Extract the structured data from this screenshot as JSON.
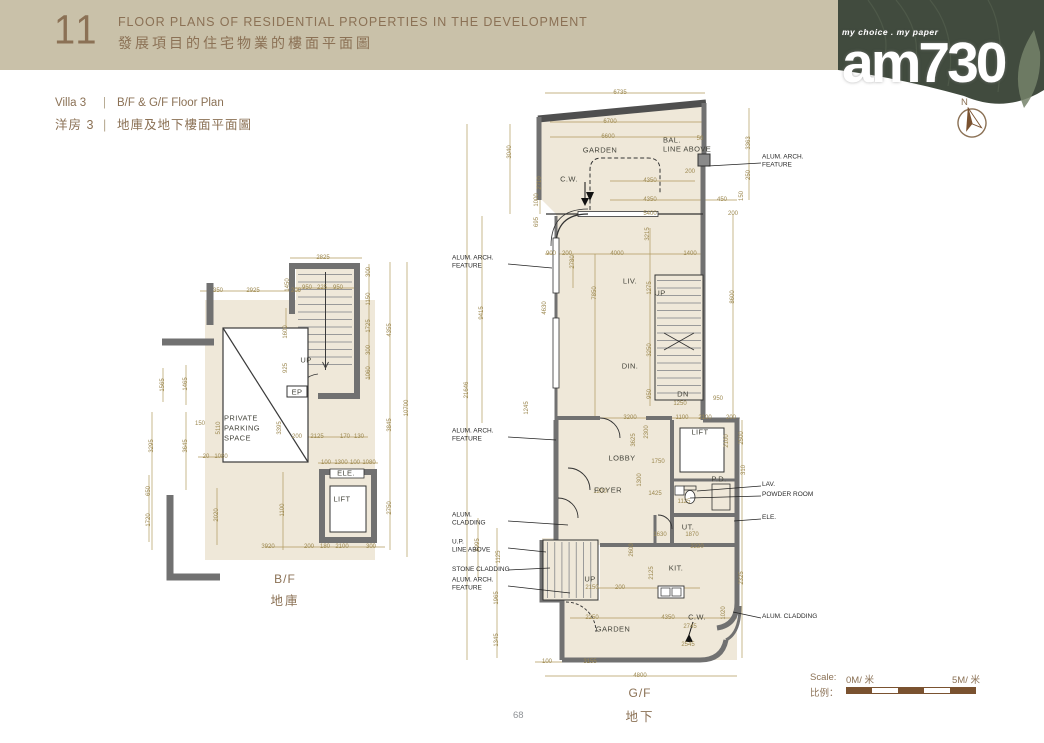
{
  "header": {
    "number": "11",
    "title_en": "FLOOR PLANS OF RESIDENTIAL PROPERTIES IN THE DEVELOPMENT",
    "title_zh": "發展項目的住宅物業的樓面平面圖"
  },
  "logo": {
    "tagline": "my choice . my paper",
    "name": "am730"
  },
  "compass": {
    "label": "N"
  },
  "subtitle": {
    "villa_en": "Villa 3",
    "sep": "|",
    "plan_en": "B/F & G/F Floor Plan",
    "villa_zh": "洋房 3",
    "plan_zh": "地庫及地下樓面平面圖"
  },
  "scale": {
    "label_en": "Scale:",
    "start": "0M/ 米",
    "end": "5M/ 米",
    "label_zh": "比例："
  },
  "page": {
    "number": "68"
  },
  "colors": {
    "banner": "#c9c1a9",
    "brown_text": "#8b7155",
    "green_corner": "#414b3e",
    "dim_gold": "#9c8850",
    "floor_cream": "#efe8d9",
    "wall_gray": "#717171",
    "scale_brown": "#7a5230"
  },
  "bf": {
    "caption_en": "B/F",
    "caption_zh": "地庫",
    "rooms": [
      {
        "x": 84,
        "y": 168,
        "t": "PRIVATE",
        "l": true
      },
      {
        "x": 84,
        "y": 178,
        "t": "PARKING",
        "l": true
      },
      {
        "x": 84,
        "y": 188,
        "t": "SPACE",
        "l": true
      },
      {
        "x": 166,
        "y": 110,
        "t": "UP"
      },
      {
        "x": 157,
        "y": 142,
        "t": "EP"
      },
      {
        "x": 206,
        "y": 223,
        "t": "ELE."
      },
      {
        "x": 202,
        "y": 249,
        "t": "LIFT"
      }
    ],
    "dims": [
      {
        "x": 183,
        "y": 8,
        "t": "2825"
      },
      {
        "x": 167,
        "y": 38,
        "t": "950"
      },
      {
        "x": 182,
        "y": 38,
        "t": "225"
      },
      {
        "x": 198,
        "y": 38,
        "t": "950"
      },
      {
        "x": 78,
        "y": 41,
        "t": "350"
      },
      {
        "x": 113,
        "y": 41,
        "t": "2925"
      },
      {
        "x": 156,
        "y": 41,
        "t": "200"
      },
      {
        "x": 148,
        "y": 35,
        "t": "1450",
        "v": true
      },
      {
        "x": 229,
        "y": 22,
        "t": "300",
        "v": true
      },
      {
        "x": 229,
        "y": 49,
        "t": "1150",
        "v": true
      },
      {
        "x": 229,
        "y": 76,
        "t": "1725",
        "v": true
      },
      {
        "x": 229,
        "y": 100,
        "t": "300",
        "v": true
      },
      {
        "x": 229,
        "y": 123,
        "t": "1060",
        "v": true
      },
      {
        "x": 250,
        "y": 80,
        "t": "4355",
        "v": true
      },
      {
        "x": 250,
        "y": 175,
        "t": "3845",
        "v": true
      },
      {
        "x": 250,
        "y": 258,
        "t": "2750",
        "v": true
      },
      {
        "x": 267,
        "y": 158,
        "t": "10700",
        "v": true
      },
      {
        "x": 23,
        "y": 135,
        "t": "1565",
        "v": true
      },
      {
        "x": 46,
        "y": 134,
        "t": "1465",
        "v": true
      },
      {
        "x": 60,
        "y": 174,
        "t": "150"
      },
      {
        "x": 12,
        "y": 196,
        "t": "3295",
        "v": true
      },
      {
        "x": 46,
        "y": 196,
        "t": "3645",
        "v": true
      },
      {
        "x": 79,
        "y": 178,
        "t": "5110",
        "v": true
      },
      {
        "x": 140,
        "y": 178,
        "t": "3395",
        "v": true
      },
      {
        "x": 146,
        "y": 82,
        "t": "1600",
        "v": true
      },
      {
        "x": 146,
        "y": 118,
        "t": "925",
        "v": true
      },
      {
        "x": 157,
        "y": 187,
        "t": "200"
      },
      {
        "x": 177,
        "y": 187,
        "t": "2125"
      },
      {
        "x": 205,
        "y": 187,
        "t": "170"
      },
      {
        "x": 219,
        "y": 187,
        "t": "130"
      },
      {
        "x": 66,
        "y": 207,
        "t": "20"
      },
      {
        "x": 81,
        "y": 207,
        "t": "1080"
      },
      {
        "x": 186,
        "y": 213,
        "t": "100"
      },
      {
        "x": 201,
        "y": 213,
        "t": "1300"
      },
      {
        "x": 215,
        "y": 213,
        "t": "100"
      },
      {
        "x": 229,
        "y": 213,
        "t": "1080"
      },
      {
        "x": 9,
        "y": 241,
        "t": "650",
        "v": true
      },
      {
        "x": 9,
        "y": 270,
        "t": "1720",
        "v": true
      },
      {
        "x": 77,
        "y": 265,
        "t": "2020",
        "v": true
      },
      {
        "x": 143,
        "y": 260,
        "t": "1100",
        "v": true
      },
      {
        "x": 128,
        "y": 297,
        "t": "3920"
      },
      {
        "x": 169,
        "y": 297,
        "t": "200"
      },
      {
        "x": 185,
        "y": 297,
        "t": "180"
      },
      {
        "x": 202,
        "y": 297,
        "t": "2100"
      },
      {
        "x": 231,
        "y": 297,
        "t": "300"
      }
    ]
  },
  "gf": {
    "caption_en": "G/F",
    "caption_zh": "地下",
    "rooms": [
      {
        "x": 150,
        "y": 62,
        "t": "GARDEN"
      },
      {
        "x": 119,
        "y": 91,
        "t": "C.W."
      },
      {
        "x": 213,
        "y": 52,
        "t": "BAL.",
        "l": true
      },
      {
        "x": 213,
        "y": 61,
        "t": "LINE ABOVE",
        "l": true
      },
      {
        "x": 180,
        "y": 193,
        "t": "LIV."
      },
      {
        "x": 210,
        "y": 205,
        "t": "UP"
      },
      {
        "x": 180,
        "y": 278,
        "t": "DIN."
      },
      {
        "x": 233,
        "y": 306,
        "t": "DN"
      },
      {
        "x": 172,
        "y": 370,
        "t": "LOBBY"
      },
      {
        "x": 158,
        "y": 402,
        "t": "FOYER"
      },
      {
        "x": 250,
        "y": 344,
        "t": "LIFT"
      },
      {
        "x": 269,
        "y": 391,
        "t": "P.D."
      },
      {
        "x": 238,
        "y": 439,
        "t": "UT."
      },
      {
        "x": 226,
        "y": 480,
        "t": "KIT."
      },
      {
        "x": 140,
        "y": 491,
        "t": "UP"
      },
      {
        "x": 163,
        "y": 541,
        "t": "GARDEN"
      },
      {
        "x": 247,
        "y": 529,
        "t": "C.W."
      }
    ],
    "annos_left": [
      {
        "y": 175,
        "lines": [
          "ALUM. ARCH.",
          "FEATURE"
        ]
      },
      {
        "y": 348,
        "lines": [
          "ALUM. ARCH.",
          "FEATURE"
        ]
      },
      {
        "y": 432,
        "lines": [
          "ALUM.",
          "CLADDING"
        ]
      },
      {
        "y": 459,
        "lines": [
          "U.P.",
          "LINE ABOVE"
        ]
      },
      {
        "y": 482,
        "lines": [
          "STONE CLADDING"
        ]
      },
      {
        "y": 497,
        "lines": [
          "ALUM. ARCH.",
          "FEATURE"
        ]
      }
    ],
    "annos_right": [
      {
        "y": 74,
        "lines": [
          "ALUM. ARCH.",
          "FEATURE"
        ]
      },
      {
        "y": 397,
        "lines": [
          "LAV."
        ]
      },
      {
        "y": 407,
        "lines": [
          "POWDER ROOM"
        ]
      },
      {
        "y": 430,
        "lines": [
          "ELE."
        ]
      },
      {
        "y": 529,
        "lines": [
          "ALUM. CLADDING"
        ]
      }
    ],
    "dims": [
      {
        "x": 170,
        "y": 5,
        "t": "6735"
      },
      {
        "x": 160,
        "y": 34,
        "t": "6700"
      },
      {
        "x": 158,
        "y": 49,
        "t": "6600"
      },
      {
        "x": 250,
        "y": 51,
        "t": "50"
      },
      {
        "x": 60,
        "y": 64,
        "t": "3040",
        "v": true
      },
      {
        "x": 90,
        "y": 95,
        "t": "2710",
        "v": true
      },
      {
        "x": 87,
        "y": 112,
        "t": "1000",
        "v": true
      },
      {
        "x": 87,
        "y": 134,
        "t": "695",
        "v": true
      },
      {
        "x": 299,
        "y": 55,
        "t": "3363",
        "v": true
      },
      {
        "x": 299,
        "y": 87,
        "t": "250",
        "v": true
      },
      {
        "x": 292,
        "y": 108,
        "t": "150",
        "v": true
      },
      {
        "x": 240,
        "y": 84,
        "t": "200"
      },
      {
        "x": 200,
        "y": 93,
        "t": "4350"
      },
      {
        "x": 200,
        "y": 112,
        "t": "4350"
      },
      {
        "x": 272,
        "y": 112,
        "t": "450"
      },
      {
        "x": 200,
        "y": 126,
        "t": "5400"
      },
      {
        "x": 283,
        "y": 126,
        "t": "200"
      },
      {
        "x": 101,
        "y": 166,
        "t": "900"
      },
      {
        "x": 117,
        "y": 166,
        "t": "200"
      },
      {
        "x": 167,
        "y": 166,
        "t": "4000"
      },
      {
        "x": 240,
        "y": 166,
        "t": "1400"
      },
      {
        "x": 123,
        "y": 174,
        "t": "2780",
        "v": true
      },
      {
        "x": 145,
        "y": 205,
        "t": "7850",
        "v": true
      },
      {
        "x": 95,
        "y": 220,
        "t": "4630",
        "v": true
      },
      {
        "x": 32,
        "y": 225,
        "t": "9415",
        "v": true
      },
      {
        "x": 17,
        "y": 302,
        "t": "21646",
        "v": true
      },
      {
        "x": 198,
        "y": 146,
        "t": "3215",
        "v": true
      },
      {
        "x": 200,
        "y": 200,
        "t": "1275",
        "v": true
      },
      {
        "x": 200,
        "y": 262,
        "t": "3250",
        "v": true
      },
      {
        "x": 200,
        "y": 306,
        "t": "950",
        "v": true
      },
      {
        "x": 283,
        "y": 209,
        "t": "8600",
        "v": true
      },
      {
        "x": 230,
        "y": 316,
        "t": "1250"
      },
      {
        "x": 268,
        "y": 311,
        "t": "950"
      },
      {
        "x": 77,
        "y": 320,
        "t": "1245",
        "v": true
      },
      {
        "x": 180,
        "y": 330,
        "t": "3200"
      },
      {
        "x": 232,
        "y": 330,
        "t": "1100"
      },
      {
        "x": 255,
        "y": 330,
        "t": "2100"
      },
      {
        "x": 281,
        "y": 330,
        "t": "200"
      },
      {
        "x": 184,
        "y": 352,
        "t": "3625",
        "v": true
      },
      {
        "x": 197,
        "y": 344,
        "t": "2300",
        "v": true
      },
      {
        "x": 277,
        "y": 353,
        "t": "2100",
        "v": true
      },
      {
        "x": 292,
        "y": 350,
        "t": "2500",
        "v": true
      },
      {
        "x": 294,
        "y": 382,
        "t": "310",
        "v": true
      },
      {
        "x": 208,
        "y": 374,
        "t": "1750"
      },
      {
        "x": 150,
        "y": 404,
        "t": "1200"
      },
      {
        "x": 205,
        "y": 406,
        "t": "1425"
      },
      {
        "x": 190,
        "y": 392,
        "t": "1300",
        "v": true
      },
      {
        "x": 234,
        "y": 414,
        "t": "1125"
      },
      {
        "x": 210,
        "y": 447,
        "t": "1630"
      },
      {
        "x": 242,
        "y": 447,
        "t": "1870"
      },
      {
        "x": 247,
        "y": 459,
        "t": "2220"
      },
      {
        "x": 182,
        "y": 462,
        "t": "2600",
        "v": true
      },
      {
        "x": 202,
        "y": 485,
        "t": "2125",
        "v": true
      },
      {
        "x": 292,
        "y": 490,
        "t": "2325",
        "v": true
      },
      {
        "x": 28,
        "y": 457,
        "t": "8995",
        "v": true
      },
      {
        "x": 49,
        "y": 469,
        "t": "1125",
        "v": true
      },
      {
        "x": 47,
        "y": 510,
        "t": "1965",
        "v": true
      },
      {
        "x": 47,
        "y": 552,
        "t": "1345",
        "v": true
      },
      {
        "x": 142,
        "y": 500,
        "t": "2150"
      },
      {
        "x": 170,
        "y": 500,
        "t": "200"
      },
      {
        "x": 142,
        "y": 530,
        "t": "2250"
      },
      {
        "x": 218,
        "y": 530,
        "t": "4350"
      },
      {
        "x": 274,
        "y": 525,
        "t": "1020",
        "v": true
      },
      {
        "x": 240,
        "y": 539,
        "t": "2745"
      },
      {
        "x": 238,
        "y": 557,
        "t": "2545"
      },
      {
        "x": 97,
        "y": 574,
        "t": "100"
      },
      {
        "x": 140,
        "y": 574,
        "t": "3155"
      },
      {
        "x": 190,
        "y": 588,
        "t": "4800"
      }
    ]
  }
}
